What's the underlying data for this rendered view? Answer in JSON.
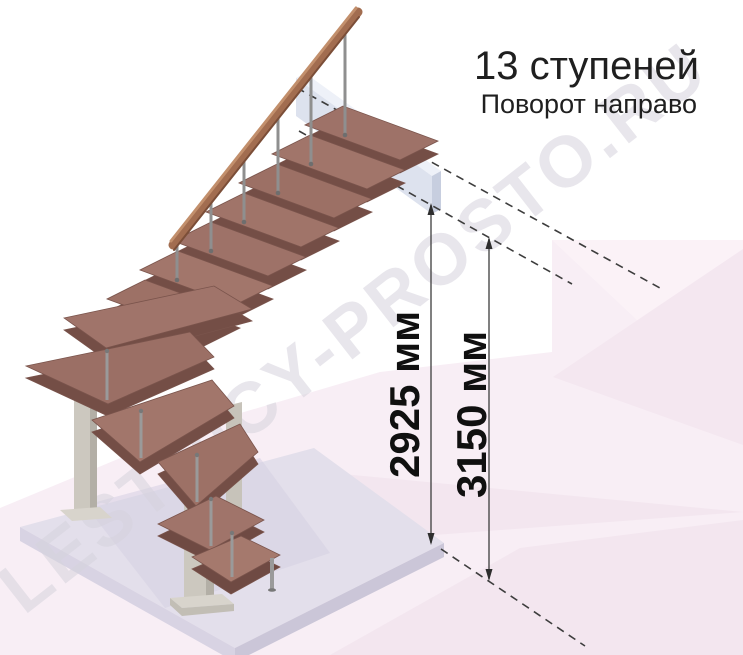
{
  "header": {
    "title": "13 ступеней",
    "subtitle": "Поворот направо"
  },
  "dimensions": {
    "to_ceiling": {
      "label": "2925 мм",
      "value": 2925,
      "unit": "мм"
    },
    "to_floor": {
      "label": "3150 мм",
      "value": 3150,
      "unit": "мм"
    }
  },
  "watermark": {
    "text": "LESTNICY-PROSTO.RU"
  },
  "illustration": {
    "steps_count": 13,
    "turn_direction": "направо",
    "colors": {
      "tread_wood": "#9e7268",
      "handrail_wood": "#a26d50",
      "metal_baluster": "#8f8f8f",
      "support_frame": "#ccc8bf",
      "upper_floor_slab": "#dde2ee",
      "base_platform": "#e3dfeb",
      "background_pink": "#f8edf4",
      "dimension_line": "#3d3d3d"
    }
  }
}
